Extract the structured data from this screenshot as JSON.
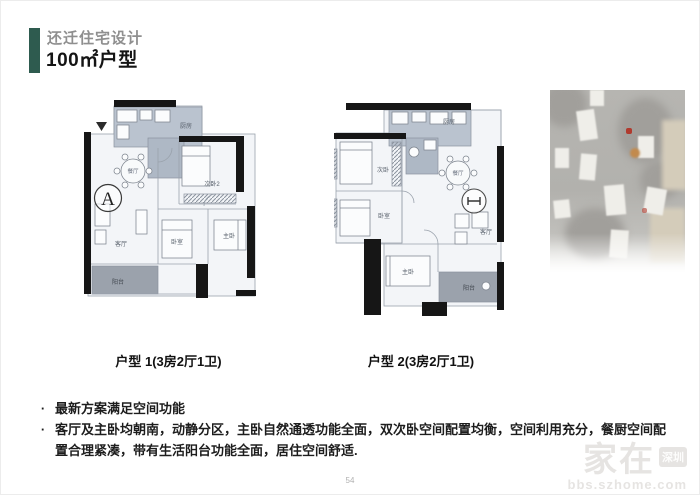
{
  "header": {
    "subtitle": "还迁住宅设计",
    "title": "100㎡户型"
  },
  "plans": [
    {
      "caption": "户型 1(3房2厅1卫)",
      "marker": "A",
      "rooms": {
        "kitchen": "厨房",
        "dining": "餐厅",
        "bedroom2": "次卧2",
        "living": "客厅",
        "bedroom": "卧室",
        "master": "主卧",
        "balcony": "阳台"
      }
    },
    {
      "caption": "户型 2(3房2厅1卫)",
      "rooms": {
        "bedroom1": "次卧",
        "kitchen": "厨房",
        "dining": "餐厅",
        "bedroom": "卧室",
        "master": "主卧",
        "living": "客厅",
        "balcony": "阳台"
      }
    }
  ],
  "bullet_marker": "·",
  "bullets": [
    "最新方案满足空间功能",
    "客厅及主卧均朝南，动静分区，主卧自然通透功能全面，双次卧空间配置均衡，空间利用充分，餐厨空间配置合理紧凑，带有生活阳台功能全面，居住空间舒适."
  ],
  "page_number": "54",
  "watermark": {
    "brand": "家在",
    "badge": "深圳",
    "url": "bbs.szhome.com"
  },
  "colors": {
    "accent_green": "#2e5b4f",
    "wall": "#161616",
    "kitchen_shade": "#bac3cf",
    "balcony_shade": "#9ba2ac"
  }
}
